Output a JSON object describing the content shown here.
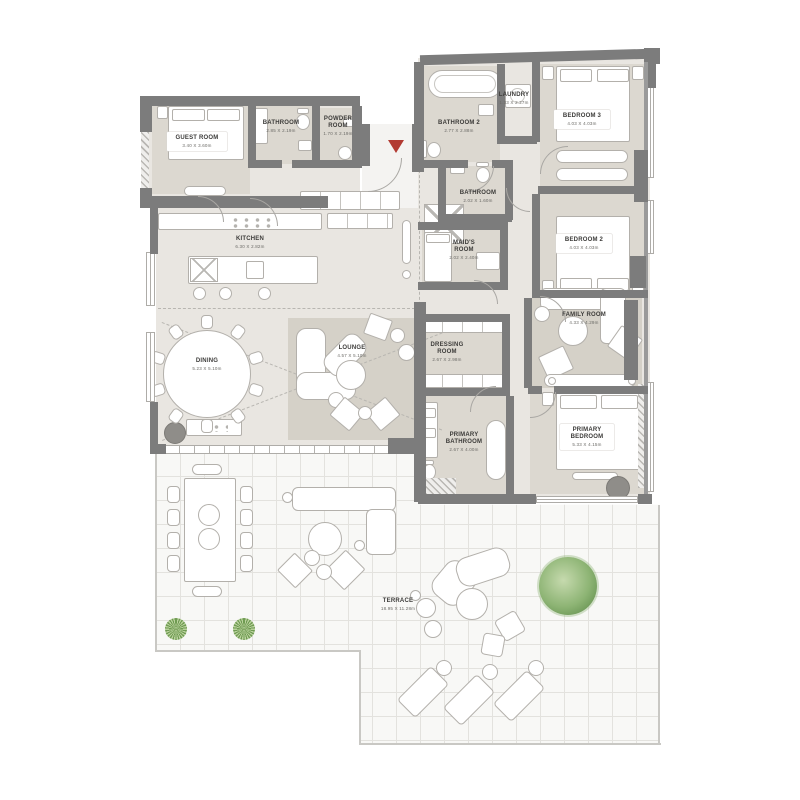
{
  "plan": {
    "marker_color": "#b23a32",
    "rooms": [
      {
        "id": "guest-room",
        "label": "GUEST ROOM",
        "dims": "3.40 X 3.60m"
      },
      {
        "id": "bathroom",
        "label": "BATHROOM",
        "dims": "2.85 X 2.19m"
      },
      {
        "id": "powder-room",
        "label": "POWDER ROOM",
        "dims": "1.70 X 2.19m"
      },
      {
        "id": "kitchen",
        "label": "KITCHEN",
        "dims": "6.30 X 2.82m"
      },
      {
        "id": "dining",
        "label": "DINING",
        "dims": "5.23 X 5.10m"
      },
      {
        "id": "lounge",
        "label": "LOUNGE",
        "dims": "4.57 X 5.10m"
      },
      {
        "id": "bathroom-2",
        "label": "BATHROOM 2",
        "dims": "2.77 X 2.88m"
      },
      {
        "id": "laundry",
        "label": "LAUNDRY",
        "dims": "1.33 X 2.27m"
      },
      {
        "id": "bedroom-3",
        "label": "BEDROOM 3",
        "dims": "4.03 X 4.03m"
      },
      {
        "id": "bathroom-middle",
        "label": "BATHROOM",
        "dims": "2.02 X 1.60m"
      },
      {
        "id": "maids-room",
        "label": "MAID'S ROOM",
        "dims": "2.02 X 2.40m"
      },
      {
        "id": "bedroom-2",
        "label": "BEDROOM 2",
        "dims": "4.03 X 4.03m"
      },
      {
        "id": "family-room",
        "label": "FAMILY ROOM",
        "dims": "4.33 X 4.29m"
      },
      {
        "id": "dressing-room",
        "label": "DRESSING ROOM",
        "dims": "2.67 X 2.98m"
      },
      {
        "id": "primary-bathroom",
        "label": "PRIMARY BATHROOM",
        "dims": "2.67 X 4.00m"
      },
      {
        "id": "primary-bedroom",
        "label": "PRIMARY BEDROOM",
        "dims": "5.33 X 4.15m"
      },
      {
        "id": "terrace",
        "label": "TERRACE",
        "dims": "18.95 X 11.28m"
      }
    ]
  }
}
